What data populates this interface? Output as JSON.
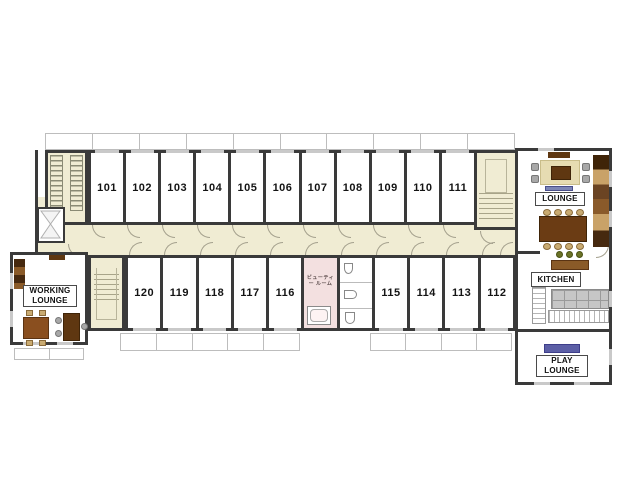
{
  "rooms": {
    "top": [
      "101",
      "102",
      "103",
      "104",
      "105",
      "106",
      "107",
      "108",
      "109",
      "110",
      "111"
    ],
    "bottom": [
      {
        "type": "room",
        "label": "120"
      },
      {
        "type": "room",
        "label": "119"
      },
      {
        "type": "room",
        "label": "118"
      },
      {
        "type": "room",
        "label": "117"
      },
      {
        "type": "room",
        "label": "116"
      },
      {
        "type": "beauty",
        "label": "ビューティー ルーム"
      },
      {
        "type": "toilet",
        "label": ""
      },
      {
        "type": "room",
        "label": "115"
      },
      {
        "type": "room",
        "label": "114"
      },
      {
        "type": "room",
        "label": "113"
      },
      {
        "type": "room",
        "label": "112"
      }
    ]
  },
  "labels": {
    "working_lounge": "WORKING LOUNGE",
    "lounge": "LOUNGE",
    "kitchen": "KITCHEN",
    "play_lounge": "PLAY LOUNGE"
  },
  "colors": {
    "wall": "#3a3a3a",
    "corridor": "#f0ecd3",
    "beauty_room": "#f3e0e0",
    "window": "#c9c9c9",
    "balcony_line": "#bdbdbd",
    "wood": "#8a5a28",
    "wood_dark": "#5f3711",
    "chair_tan": "#c9ab72",
    "chair_gray": "#a8a8a8",
    "stool_green": "#6b7226",
    "mat_purple": "#5c5fa6"
  }
}
